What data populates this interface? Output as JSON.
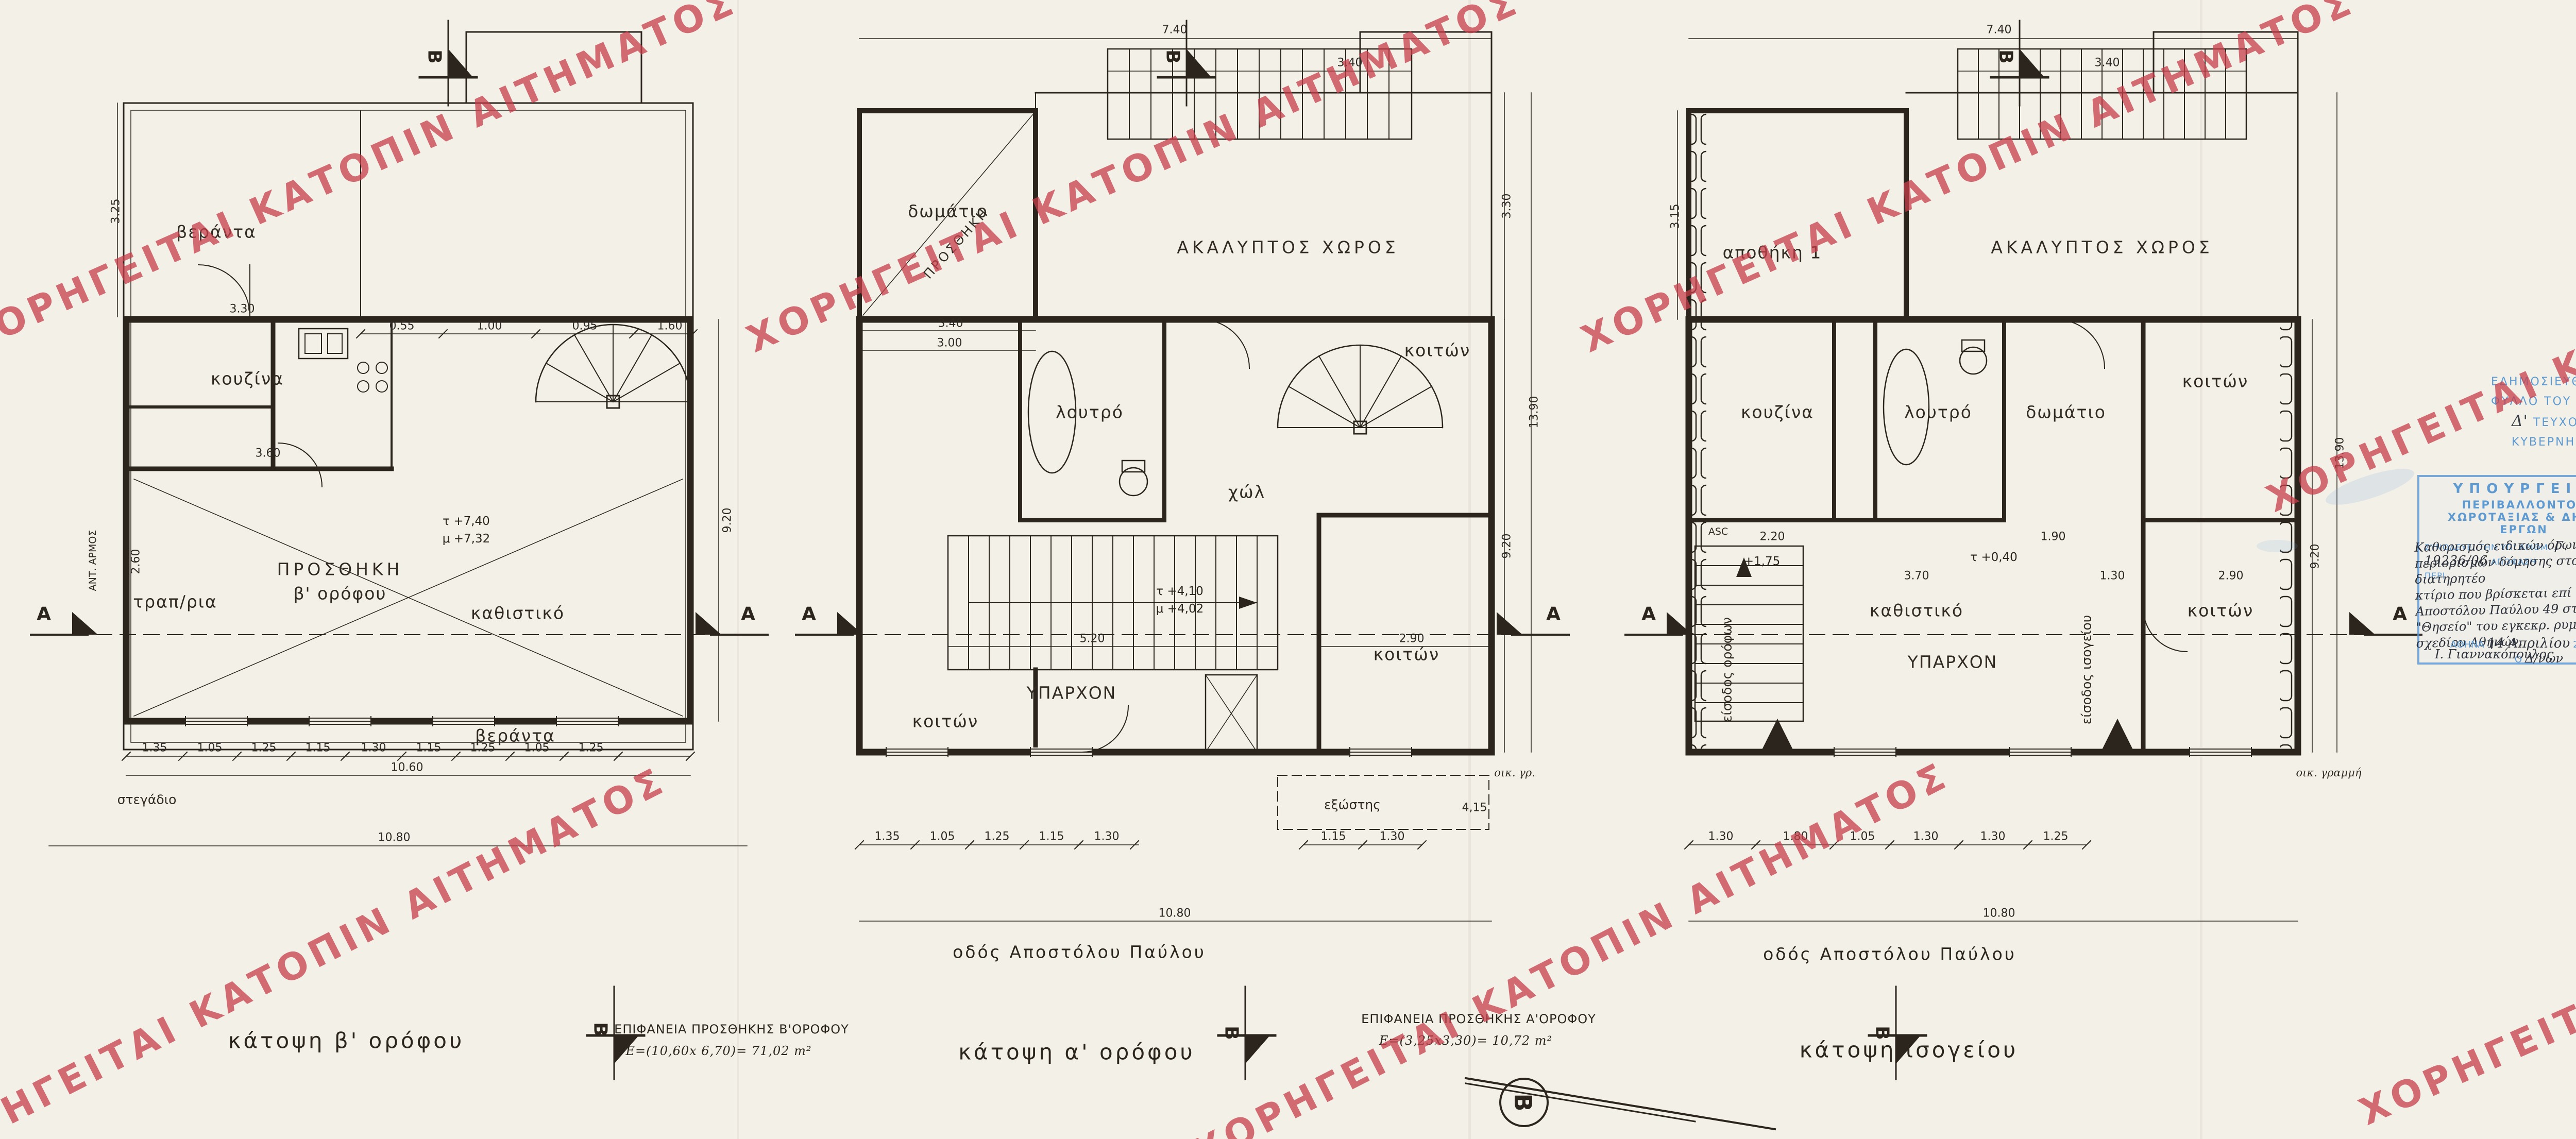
{
  "watermark": {
    "text": "ΧΟΡΗΓΕΙΤΑΙ ΚΑΤΟΠΙΝ ΑΙΤΗΜΑΤΟΣ",
    "color": "#c73e4a"
  },
  "street_label": "οδός  Αποστόλου  Παύλου",
  "marks": {
    "a": "A",
    "b": "B",
    "north": "Β"
  },
  "plans": [
    {
      "caption": "κάτοψη  β' ορόφου",
      "rooms": {
        "veranda_top": "βεράντα",
        "kitchen": "κουζίνα",
        "dining": "τραπ/ρια",
        "addition_line1": "ΠΡΟΣΘΗΚΗ",
        "addition_line2": "β'  ορόφου",
        "living": "καθιστικό",
        "veranda_bottom": "βεράντα",
        "shed": "στεγάδιο"
      },
      "levels": {
        "top": "τ +7,40",
        "bottom": "μ +7,32"
      },
      "area_note": {
        "line1": "ΕΠΙΦΑΝΕΙΑ  ΠΡΟΣΘΗΚΗΣ  Β'ΟΡΟΦΟΥ",
        "line2": "Ε=(10,60x 6,70)= 71,02 m²"
      },
      "dims": {
        "left": "3.25",
        "upper": "3.30",
        "kitchen": "3.60",
        "left_inner": "2.60",
        "top_chain": [
          "0.55",
          "1.00",
          "0.95",
          "1.60"
        ],
        "bottom_chain": [
          "1.35",
          "1.05",
          "1.25",
          "1.15",
          "1.30",
          "1.15",
          "1.25",
          "1.05",
          "1.25"
        ],
        "subtotal": "10.60",
        "total": "10.80",
        "right": "9.20",
        "joint": "ΑΝΤ. ΑΡΜΟΣ"
      }
    },
    {
      "caption": "κάτοψη  α' ορόφου",
      "rooms": {
        "bedroom_top": "δωμάτιο",
        "addition_diag": "ΠΡΟΣΘΗΚΗ",
        "court": "ΑΚΑΛΥΠΤΟΣ  ΧΩΡΟΣ",
        "bath": "λουτρό",
        "hall": "χώλ",
        "bedroom_right_top": "κοιτών",
        "existing": "ΥΠΑΡΧΟΝ",
        "bedroom_left": "κοιτών",
        "bedroom_right": "κοιτών",
        "balcony": "εξώστης"
      },
      "levels": {
        "top": "τ +4,10",
        "bottom": "μ +4,02"
      },
      "building_line": "οικ. γρ.",
      "area_note": {
        "line1": "ΕΠΙΦΑΝΕΙΑ  ΠΡΟΣΘΗΚΗΣ  Α'ΟΡΟΦΟΥ",
        "line2": "Ε=(3,25x3,30)= 10,72 m²"
      },
      "dims": {
        "top_total": "7.40",
        "top_stair": "3.40",
        "room_w": "3.40",
        "room_w2": "3.00",
        "bottom_chain": [
          "1.35",
          "1.05",
          "1.25",
          "1.15",
          "1.30"
        ],
        "balcony_chain": [
          "1.15",
          "1.30"
        ],
        "balcony_len": "4,15",
        "total": "10.80",
        "right": [
          "3.30",
          "13.90",
          "9.20"
        ],
        "inner": [
          "5.20",
          "2.90"
        ]
      }
    },
    {
      "caption": "κάτοψη  ισογείου",
      "rooms": {
        "storage": "αποθήκη 1",
        "court": "ΑΚΑΛΥΠΤΟΣ  ΧΩΡΟΣ",
        "kitchen": "κουζίνα",
        "bath": "λουτρό",
        "room": "δωμάτιο",
        "bedroom_top": "κοιτών",
        "living": "καθιστικό",
        "existing": "ΥΠΑΡΧΟΝ",
        "bedroom_right": "κοιτών",
        "entrance_floors": "είσοδος ορόφων",
        "entrance_ground": "είσοδος ισογείου",
        "lift": "ASC"
      },
      "levels": {
        "upper": "+1,75",
        "entry": "τ +0,40"
      },
      "building_line": "οικ. γραμμή",
      "dims": {
        "top_total": "7.40",
        "top_stair": "3.40",
        "left": "3.15",
        "bottom_chain": [
          "1.30",
          "1.80",
          "1.05",
          "1.30",
          "1.30",
          "1.25"
        ],
        "total": "10.80",
        "right": [
          "13.90",
          "9.20"
        ],
        "inner": [
          "2.20",
          "1.90",
          "3.70",
          "1.30",
          "2.90"
        ]
      }
    }
  ],
  "fek_stamp": {
    "line1_pre": "ΕΔΗΜΟΣΙΕΥΘΗ ΕΙΣ ΤΟ ΥΠ' ΑΡΙΘΜ.",
    "line1_hand": "498",
    "line1_post": "ΦΥΛΛΟ ΤΟΥ",
    "line2_hand": "Δ'",
    "line2": "ΤΕΥΧΟΥΣ ΤΗΣ ΕΦΗΜΕΡΙΔΑΣ ΤΗΣ ΚΥΒΕΡΝΗΣΕΩΣ",
    "line3_pre": "ΤΗΣ",
    "line3_hand": "7 Ιουνίου",
    "line3_post": "2006"
  },
  "ministry_stamp": {
    "title": "ΥΠΟΥΡΓΕΙΟ",
    "subtitle": "ΠΕΡΙΒΑΛΛΟΝΤΟΣ ΧΩΡΟΤΑΞΙΑΣ & ΔΗΜ. ΕΡΓΩΝ",
    "ref_pre": "ΣΥΝΟΔΕΥΕΙ ΤΗΝ ΥΠ' ΑΡΙΘΜ.",
    "ref_hand": "Γ. 19236/06",
    "ref_post": "ΑΠΟΦΑΣΗ",
    "peri_label": "ΠΕΡΙ",
    "body_line1": "Καθορισμός ειδικών όρων και",
    "body_line2": "περιορισμών δόμησης στο διατηρητέο",
    "body_line3": "κτίριο που βρίσκεται επί της οδού",
    "body_line4": "Αποστόλου Παύλου 49 στη περιοχή",
    "body_line5": "\"Θησείο\" του εγκεκρ. ρυμοτομ.",
    "body_line6": "σχεδίου Αθηνών.",
    "city_label": "ΑΘΗΝΑ",
    "date_hand": "14 Απριλίου",
    "year": "200",
    "year_hand": "6",
    "signer_pre": "Ο",
    "signer_role": "Δ/νων",
    "signature": "Ι. Γιαννακόπουλος"
  },
  "file_note": {
    "line1": "Σχ.5",
    "line2": "ΦΑΚ: 70/06"
  },
  "title_block": {
    "ministry_line1": "ΥΠΟΥΡΓΕΙΟ ΠΕΡΙΒΑΛΛΟΝΤΟΣ,",
    "ministry_line2": "ΧΩΡΟΤΑΞΙΑΣ",
    "ministry_line3": "ΚΑΙ ΔΗΜΟΣΙΩΝ ΕΡΓΩΝ",
    "direction_line1": "ΔΙΕΥΘΥΝΣΗ ΠΟΛΕΟΔΟΜΙΚΟΥ ΣΧΕΔΙΑΣΜΟΥ",
    "direction_line2": "ΤΜΗΜΑ ΠΑΡΑΔΟΣΙΑΚΩΝ ΟΙΚΙΣΜΩΝ",
    "thesi_label": "ΘΕΣΗ :",
    "thesi_line1": "ΔΗΜΟΣ ΑΘΗΝΑΙΩΝ,   ΠΕΡΙΟΧΗ ΘΗΣΕΙΟΥ",
    "thesi_line2": "ΑΠΟΣΤΟΛΟΥ ΠΑΥΛΟΥ 49",
    "thema_label": "ΘΕΜΑ :",
    "thema_line1": "ΚΑΘΟΡΙΣΜΟΣ ΕΙΔΙΚΩΝ ΟΡΩΝ ΚΑΙ",
    "thema_line2": "ΠΕΡΙΟΡΙΣΜΩΝ ΔΟΜΗΣΗΣ ΣΤΟ ΔΙΑΤΗΡΗΤΕΟ",
    "thema_line3": "ΚΤΙΡΙΟ ΕΠΙ ΤΗΣ ΟΔΟΥ ΑΠΟΣΤΟΛΟΥ",
    "thema_line4": "ΠΑΥΛΟΥ 49",
    "titlos_label": "ΤΙΤΛΟΣ ΣΧΕΔΙΟΥ :",
    "titlos_line1": "ΚΑΤΟΨΕΙΣ  ΙΣΟΓΕΙΟΥ",
    "titlos_line2": "Α' ΟΡΟΦΟΥ",
    "titlos_line3": "Β' ΟΡΟΦΟΥ",
    "klimaka_label": "ΚΛΙΜΑΚΑ :",
    "klimaka_value": "1: 50"
  }
}
